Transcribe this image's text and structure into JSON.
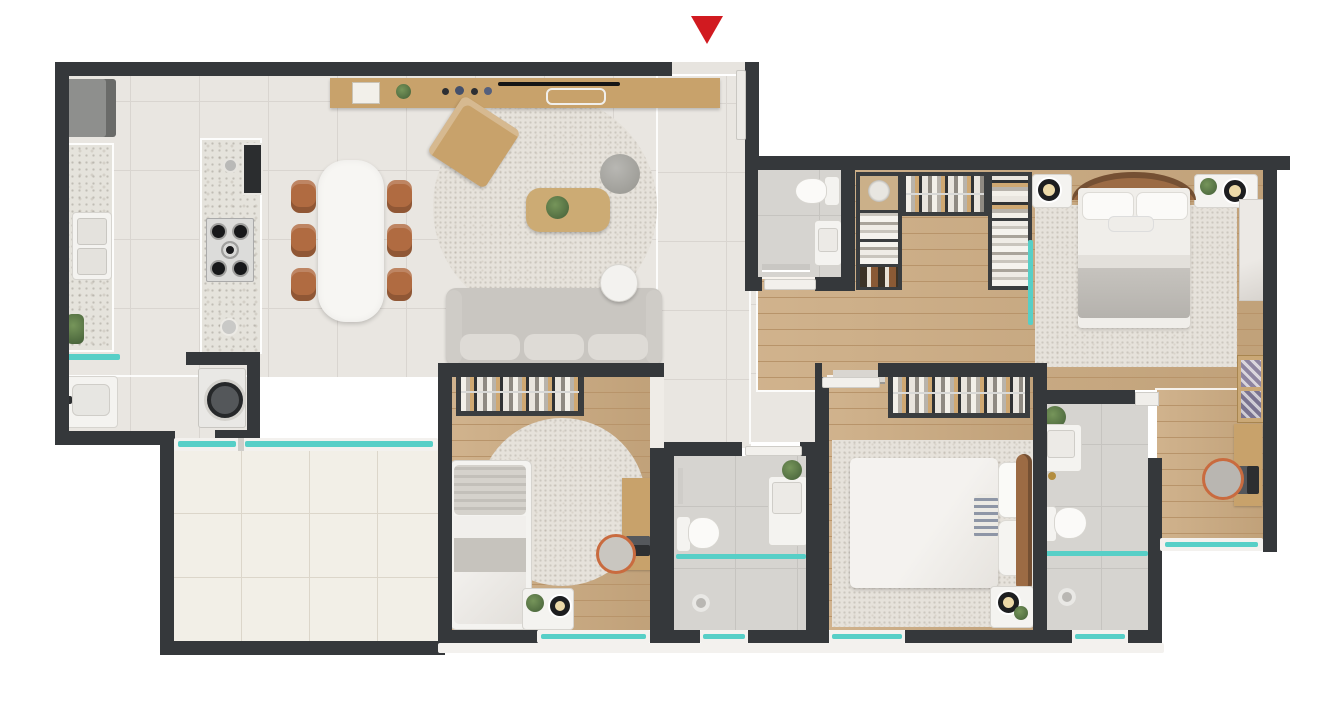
{
  "figure": {
    "type": "3d-floor-plan-render",
    "description": "Top-down 3D architectural render of a 3-bedroom apartment with kitchen/living area, balcony, walk-in closet and three bathrooms. No text labels are rendered.",
    "entry_marker": {
      "icon": "triangle-down-icon",
      "meaning": "apartment entrance",
      "color": "#d11a20"
    }
  },
  "palette": {
    "wall": "#35383b",
    "tile_floor": "#e9e6e1",
    "tile_line": "#d9d5d0",
    "balcony_tile": "#f2efe7",
    "balcony_line": "#dcd6ca",
    "wood_floor": "#cbaa80",
    "wood_line": "#b8946a",
    "bath_tile": "#d6d4d0",
    "bath_line": "#c6c4c0",
    "rug": "#e6e2db",
    "counter": "#e5e3dc",
    "accent_red": "#d11a20",
    "glass_teal": "#57cfc7",
    "white_fixture": "#f4f3f0",
    "sofa": "#c9c6c1",
    "cushion": "#dedbd6",
    "wood_furniture": "#c8a26b",
    "chair_brown": "#b06b41",
    "dark_frame": "#3a3d3f",
    "steel": "#dcdcda",
    "plant_green": "#5d7d4a",
    "lamp_amber": "#ecd9a8",
    "headboard_brown": "#9c6b44",
    "appliance_gray": "#8e8f8d"
  },
  "rooms": [
    {
      "name": "entry",
      "features": [
        "entrance-door",
        "entrance-arrow"
      ]
    },
    {
      "name": "kitchen",
      "features": [
        "refrigerator",
        "wall-counter",
        "double-sink",
        "island-counter",
        "gas-cooktop",
        "island-sink",
        "wine-niche",
        "plant"
      ]
    },
    {
      "name": "dining-area",
      "features": [
        "dining-table",
        "chairs-x6"
      ]
    },
    {
      "name": "living-room",
      "features": [
        "tv-sideboard",
        "tv",
        "round-rug",
        "armchair",
        "coffee-table",
        "plant",
        "side-pouf",
        "sofa",
        "round-side-table"
      ]
    },
    {
      "name": "laundry-area",
      "features": [
        "laundry-tub",
        "washing-machine",
        "glass-door"
      ]
    },
    {
      "name": "balcony",
      "features": [
        "large-floor-tiles",
        "glass-windows"
      ]
    },
    {
      "name": "bedroom-2",
      "features": [
        "open-wardrobe",
        "single-bed",
        "round-rug",
        "desk",
        "laptop",
        "desk-chair",
        "nightstand",
        "lamp",
        "plant",
        "window"
      ]
    },
    {
      "name": "hall-bathroom",
      "features": [
        "toilet",
        "vanity-sink",
        "glass-shower-partition",
        "shower-drain",
        "plant",
        "window"
      ]
    },
    {
      "name": "bedroom-3",
      "features": [
        "open-wardrobe",
        "wall-shelf",
        "double-bed",
        "rug",
        "nightstand",
        "lamp",
        "plant",
        "window"
      ]
    },
    {
      "name": "social-bathroom",
      "features": [
        "toilet",
        "vanity-sink",
        "towel-shelf",
        "door"
      ]
    },
    {
      "name": "walk-in-closet",
      "features": [
        "mirror-unit",
        "bag-shelves",
        "shoe-shelves",
        "hanging-rack",
        "folded-clothes-shelves"
      ]
    },
    {
      "name": "master-bedroom",
      "features": [
        "double-bed",
        "curved-headboard",
        "rug",
        "nightstand-left",
        "nightstand-right",
        "lamps-x2",
        "plant",
        "marble-panel"
      ]
    },
    {
      "name": "master-desk-nook",
      "features": [
        "desk",
        "laptop",
        "desk-chair",
        "display-shelves",
        "window"
      ]
    },
    {
      "name": "master-bathroom",
      "features": [
        "vanity-sink",
        "toilet",
        "glass-shower-partition",
        "shower-drain",
        "plant",
        "window"
      ]
    }
  ],
  "counts": {
    "bedrooms": 3,
    "bathrooms": 3,
    "balconies": 1
  }
}
